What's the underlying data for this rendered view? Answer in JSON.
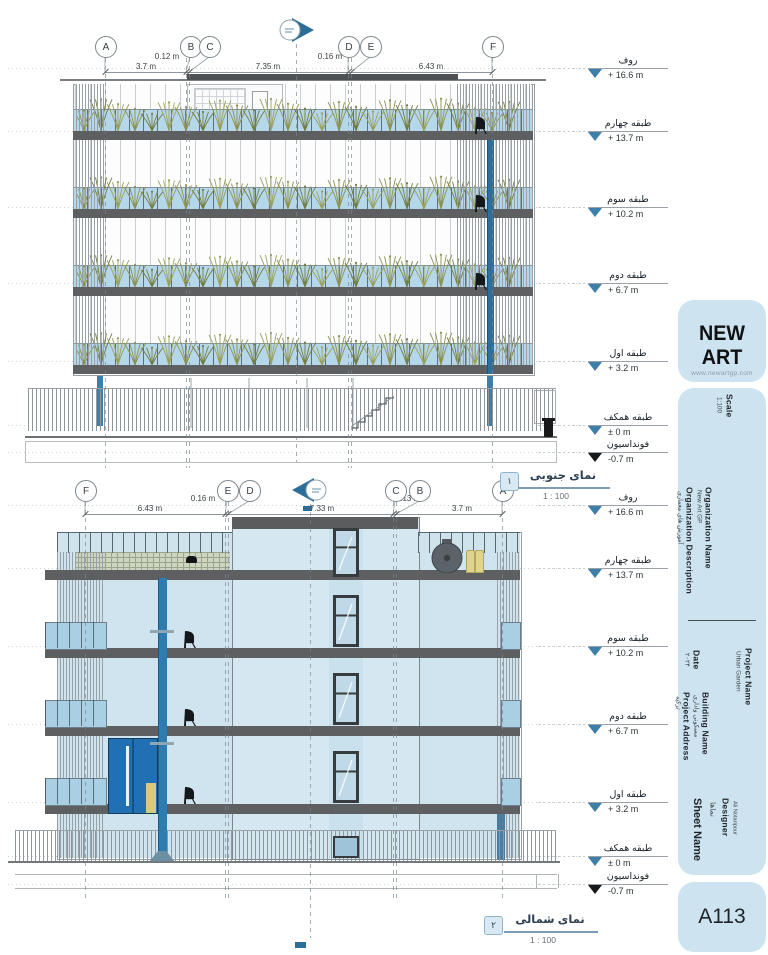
{
  "levels": [
    {
      "label": "روف",
      "value": "+ 16.6 m"
    },
    {
      "label": "طبقه چهارم",
      "value": "+ 13.7 m"
    },
    {
      "label": "طبقه سوم",
      "value": "+ 10.2 m"
    },
    {
      "label": "طبقه دوم",
      "value": "+ 6.7 m"
    },
    {
      "label": "طبقه اول",
      "value": "+ 3.2 m"
    },
    {
      "label": "طبقه همکف",
      "value": "± 0 m"
    },
    {
      "label": "فونداسیون",
      "value": "-0.7 m"
    }
  ],
  "views": [
    {
      "name": "نمای جنوبی",
      "scale": "1 : 100",
      "number": "۱",
      "grids": [
        "A",
        "B",
        "C",
        "D",
        "E",
        "F"
      ],
      "dims": [
        "3.7 m",
        "0.12 m",
        "7.35 m",
        "0.16 m",
        "6.43 m"
      ]
    },
    {
      "name": "نمای شمالی",
      "scale": "1 : 100",
      "number": "۲",
      "grids": [
        "F",
        "E",
        "D",
        "C",
        "B",
        "A"
      ],
      "dims": [
        "6.43 m",
        "0.16 m",
        "7.33 m",
        "0.13 m",
        "3.7 m"
      ]
    }
  ],
  "title_block": {
    "logo_text": "NEW ART",
    "logo_url": "www.newartgp.com",
    "sheet_number": "A113",
    "scale_label": "Scale",
    "scale_value": "1:100",
    "org_name_label": "Organization Name",
    "org_name_value": "New Art GP",
    "org_desc_label": "Organization Description",
    "org_desc_value": "آموزش های معماری",
    "date_label": "Date",
    "date_value": "۲۰۲۴",
    "project_name_label": "Project Name",
    "project_name_value": "Urban Garden",
    "building_name_label": "Building Name",
    "building_name_value": "مسکونی واداری",
    "project_address_label": "Project Address",
    "project_address_value": "ترکیه",
    "sheet_name_label": "Sheet Name",
    "sheet_name_value": "نماها",
    "designer_label": "Designer",
    "designer_value": "Ali Notaripour"
  },
  "colors": {
    "accent_blue": "#2d6e99",
    "panel_blue": "#cde4f0",
    "glass_blue": "#b5d7ea",
    "wall_blue": "#cfe4ee",
    "slab_gray": "#5d5f60",
    "plant_green": "#8d9150"
  }
}
